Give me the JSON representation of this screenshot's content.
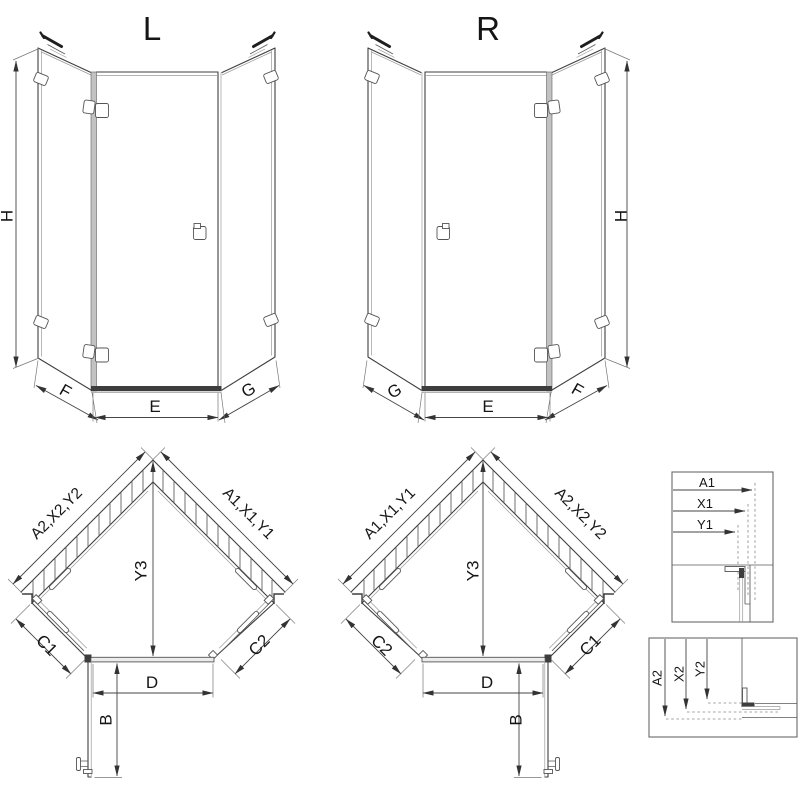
{
  "figure": {
    "front_left": {
      "title": "L",
      "height": "H",
      "left_width": "F",
      "center_width": "E",
      "right_width": "G"
    },
    "front_right": {
      "title": "R",
      "height": "H",
      "left_width": "G",
      "center_width": "E",
      "right_width": "F"
    },
    "plan_left": {
      "left_wall": "A2,X2,Y2",
      "right_wall": "A1,X1,Y1",
      "center_height": "Y3",
      "left_side": "C1",
      "right_side": "C2",
      "door_width": "D",
      "door_depth": "B"
    },
    "plan_right": {
      "left_wall": "A1,X1,Y1",
      "right_wall": "A2,X2,Y2",
      "center_height": "Y3",
      "left_side": "C2",
      "right_side": "C1",
      "door_width": "D",
      "door_depth": "B"
    },
    "detail_top": {
      "labels": [
        "A1",
        "X1",
        "Y1"
      ]
    },
    "detail_bottom": {
      "labels": [
        "A2",
        "X2",
        "Y2"
      ]
    },
    "colors": {
      "line": "#3f3f3f",
      "glass": "#9a9a9a",
      "dark_fill": "#3d3d3d",
      "background": "#ffffff"
    }
  }
}
